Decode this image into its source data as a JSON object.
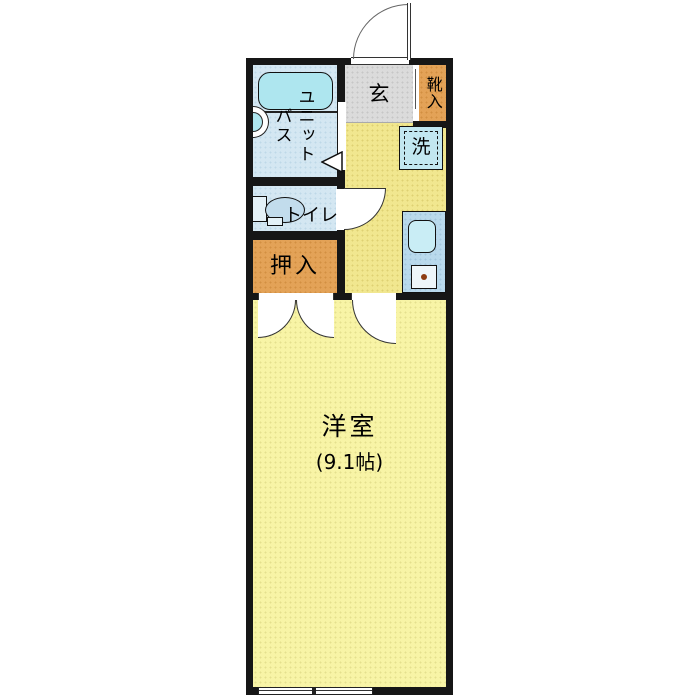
{
  "type": "apartment-floor-plan",
  "labels": {
    "unit_bath_col1": "ユニット",
    "unit_bath_col2": "バス",
    "entrance": "玄",
    "shoe_box": "靴入",
    "washer": "洗",
    "toilet": "トイレ",
    "closet": "押入",
    "main_room": "洋室",
    "main_room_size": "(9.1帖)"
  },
  "colors": {
    "wall": "#161616",
    "main_room_yellow": "#f8f4a6",
    "kitchen_yellow": "#f1e78f",
    "entrance_gray": "#dbdbdb",
    "storage_orange": "#e3a257",
    "wet_area_blue": "#d4e7f2",
    "bathtub_cyan": "#aee6ef",
    "kitchen_counter_blue": "#b9d9ec",
    "stove_dot_brown": "#8d3c12"
  }
}
